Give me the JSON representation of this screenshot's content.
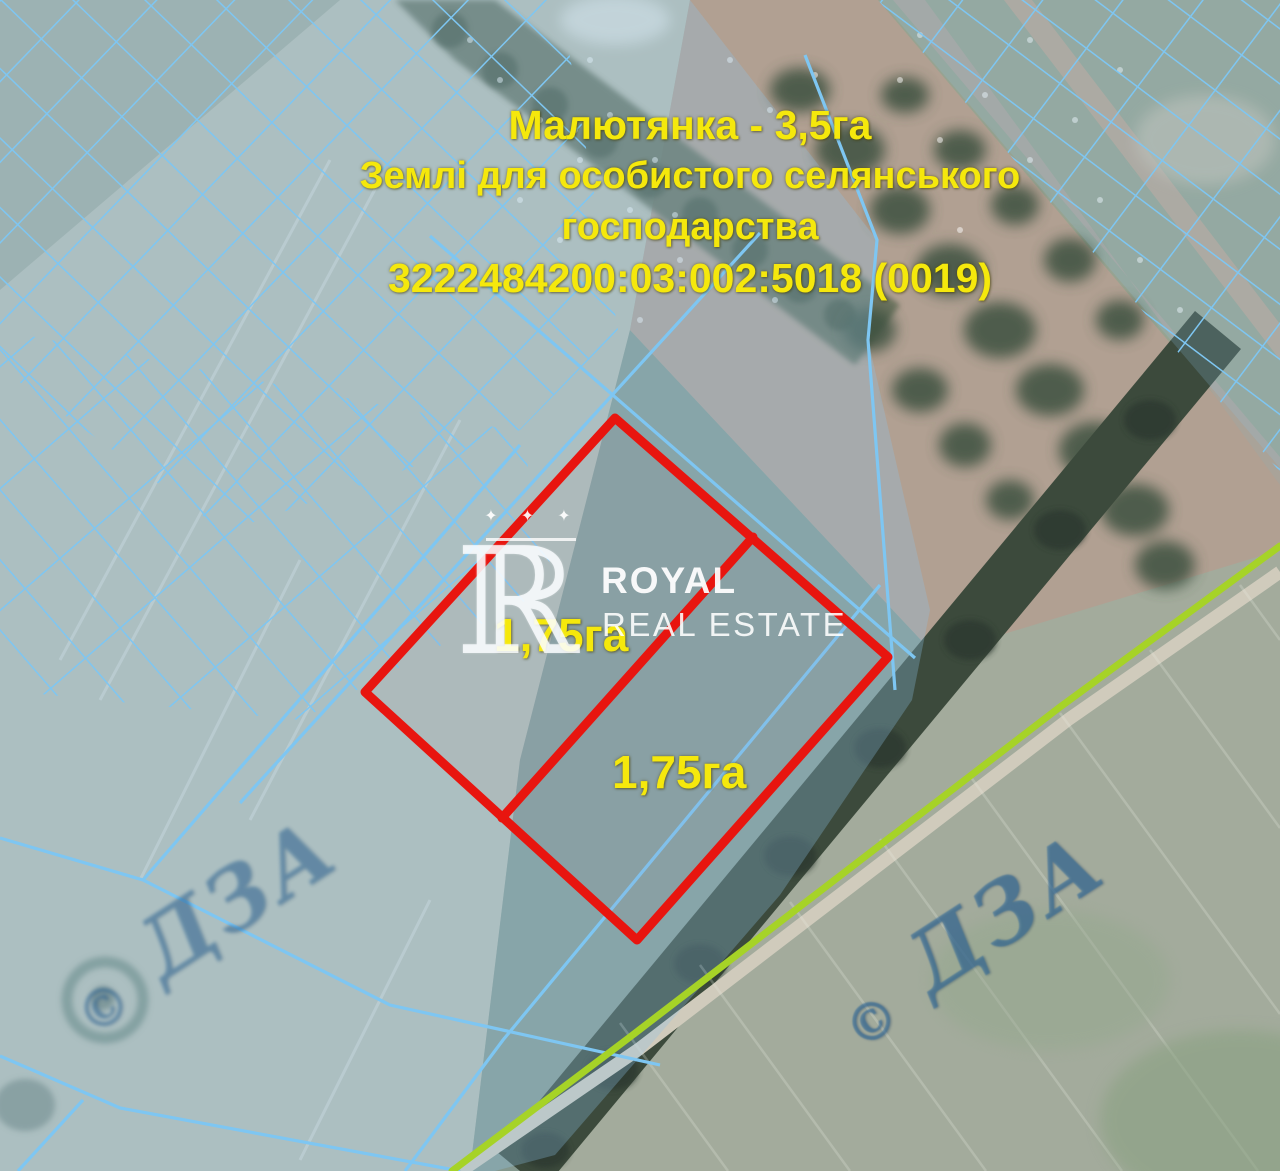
{
  "map": {
    "annotation": {
      "line1": "Малютянка - 3,5га",
      "line2": "Землі для особистого селянського",
      "line3": "господарства",
      "line4": "3222484200:03:002:5018 (0019)"
    },
    "plots": {
      "left_area": "1,75га",
      "right_area": "1,75га"
    },
    "brand": {
      "stars": "✦ ✦ ✦",
      "monogram": "ℝ",
      "name": "ROYAL",
      "tagline": "REAL ESTATE"
    },
    "cadastre_watermark": {
      "copyright": "©",
      "text": "ДЗА"
    },
    "colors": {
      "label_yellow": "#f5e80c",
      "plot_red": "#e8150f",
      "cadastral_blue": "#7ec6f2",
      "road_green": "#a6d327"
    }
  }
}
